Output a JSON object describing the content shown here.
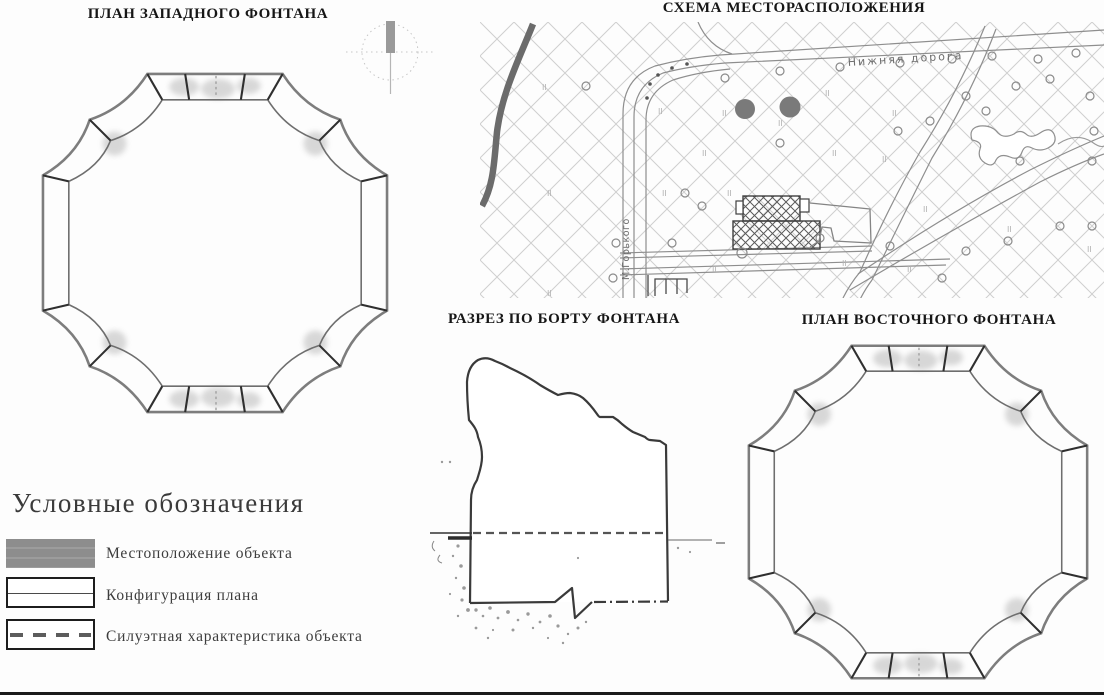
{
  "titles": {
    "west_plan": "ПЛАН ЗАПАДНОГО ФОНТАНА",
    "location_scheme": "СХЕМА МЕСТОРАСПОЛОЖЕНИЯ",
    "section": "РАЗРЕЗ ПО БОРТУ ФОНТАНА",
    "east_plan": "ПЛАН ВОСТОЧНОГО ФОНТАНА"
  },
  "map": {
    "road_label": "Нижняя дорога",
    "street_label": "М.Горького",
    "grass_symbol": "II"
  },
  "legend": {
    "title": "Условные обозначения",
    "items": [
      {
        "label": "Местоположение объекта",
        "swatch_style": "solid-gray-bar",
        "swatch_color": "#8b8b8b"
      },
      {
        "label": "Конфигурация плана",
        "swatch_style": "outlined-bar-solid-midline"
      },
      {
        "label": "Силуэтная характеристика объекта",
        "swatch_style": "outlined-bar-dashed-midline"
      }
    ]
  },
  "colors": {
    "ink": "#2f2f2f",
    "drawing_gray": "#7d7d7d",
    "object_marker": "#7a7a7a",
    "hatch": "#cfcfcf"
  }
}
